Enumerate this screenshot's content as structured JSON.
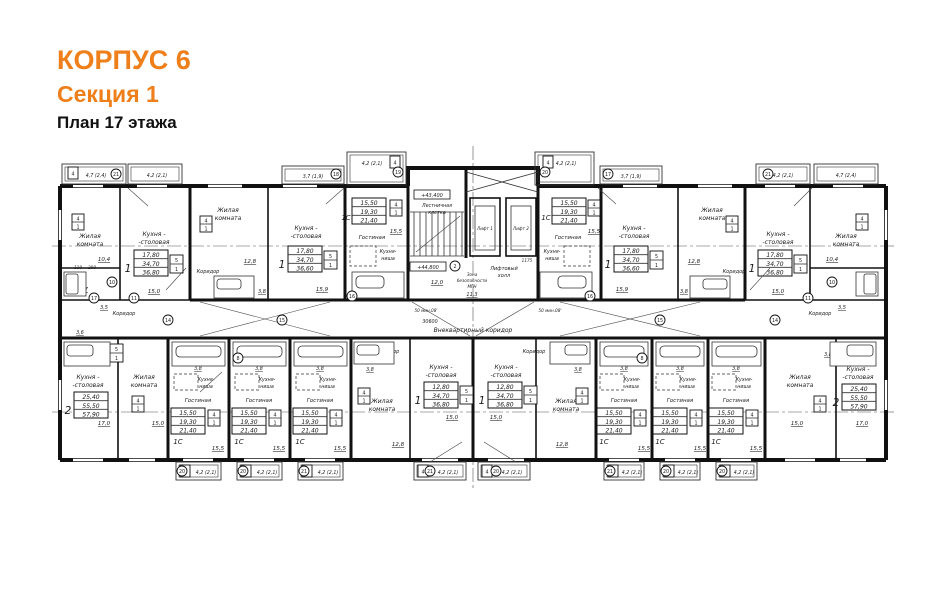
{
  "header": {
    "building": "КОРПУС 6",
    "section": "Секция 1",
    "floor": "План 17 этажа"
  },
  "colors": {
    "accent": "#EF7F1A",
    "ink": "#1A1A1A"
  },
  "labels": {
    "living1": "Жилая",
    "living2": "комната",
    "kitchen1": "Кухня -",
    "kitchen2": "-столовая",
    "niche1": "Кухня-",
    "niche2": "ниша",
    "gostinaya": "Гостиная",
    "corridor": "Коридор",
    "common_corridor": "Внеквартирный коридор",
    "stair1": "Лестничная",
    "stair2": "клетка",
    "lift1": "Лифт 1",
    "lift2": "Лифт 2",
    "lifthall1": "Лифтовый",
    "lifthall2": "холл",
    "safety1": "Зона",
    "safety2": "безопасности",
    "safety3": "МГН",
    "elev_upper": "+43,400",
    "elev_lower": "+44,800",
    "fire_note": "50 мин.08'"
  },
  "areas": {
    "bedroom_corner": "10,4",
    "bedroom_mid": "12,8",
    "kitchen_corner": "15,0",
    "kitchen_mid": "15,9",
    "kitchen_1br": "15,0",
    "studio_living": "15,5",
    "bath": "3,8",
    "bath_corner": "3,7",
    "hall_corner": "3,5",
    "hall_2br": "3,6",
    "kitchen_2br": "17,0",
    "living_2br": "15,0",
    "lifthall": "11,3",
    "stair": "12,0"
  },
  "tables": {
    "corner": {
      "num": "1",
      "rows": [
        "17,80",
        "34,70",
        "36,80"
      ]
    },
    "mid": {
      "num": "1",
      "rows": [
        "17,80",
        "34,70",
        "36,60"
      ]
    },
    "onebr": {
      "num": "1",
      "rows": [
        "12,80",
        "34,70",
        "36,80"
      ]
    },
    "studio": {
      "num": "1С",
      "rows": [
        "15,50",
        "19,30",
        "21,40"
      ]
    },
    "twobr": {
      "num": "2",
      "rows": [
        "25,40",
        "55,50",
        "57,90"
      ]
    }
  },
  "balconies": {
    "corner": "4,7 (2,4)",
    "standard": "4,2 (2,1)",
    "small": "3,7 (1,9)"
  },
  "marks": {
    "w4": "4",
    "w1": "1",
    "w5": "5",
    "w6": "6",
    "w2": "2"
  },
  "keynotes": {
    "k2": "2",
    "k8": "8",
    "k10": "10",
    "k11": "11",
    "k14": "14",
    "k15": "15",
    "k16": "16",
    "k17": "17",
    "k18": "18",
    "k19": "19",
    "k20": "20",
    "k21": "21"
  },
  "dims": {
    "total": "30600",
    "lift": "1175",
    "d110": "110",
    "d200": "200"
  }
}
